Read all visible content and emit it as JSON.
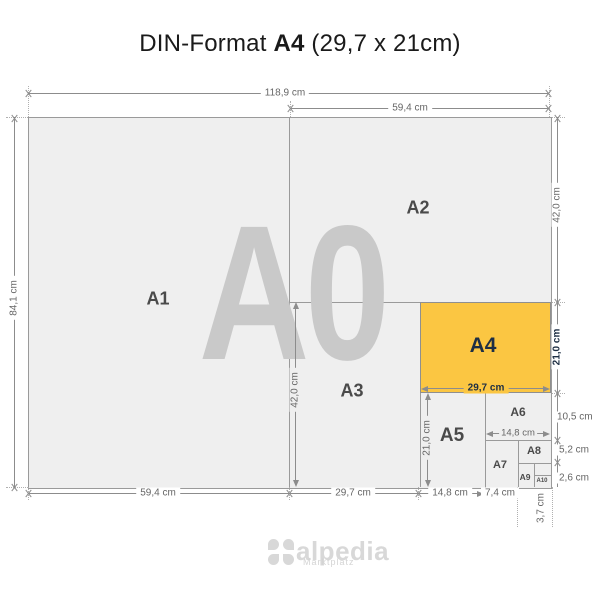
{
  "title": {
    "prefix": "DIN-Format",
    "format": "A4",
    "size": "(29,7 x 21cm)"
  },
  "watermark": "A0",
  "formats": {
    "a1": "A1",
    "a2": "A2",
    "a3": "A3",
    "a4": "A4",
    "a5": "A5",
    "a6": "A6",
    "a7": "A7",
    "a8": "A8",
    "a9": "A9",
    "a10": "A10"
  },
  "dims": {
    "top_full": "118,9 cm",
    "top_half": "59,4 cm",
    "left_height": "84,1 cm",
    "right_a2": "42,0 cm",
    "right_a4": "21,0 cm",
    "right_a6": "10,5 cm",
    "right_a8": "5,2 cm",
    "right_a10": "2,6 cm",
    "bottom_a1": "59,4 cm",
    "bottom_a3": "29,7 cm",
    "bottom_a5": "14,8 cm",
    "bottom_a7": "7,4 cm",
    "bottom_a9": "3,7 cm",
    "inner_a3_height": "42,0 cm",
    "inner_a5_height": "21,0 cm",
    "inner_a4_width": "29,7 cm",
    "inner_a6_width": "14,8 cm"
  },
  "logo": {
    "name": "alpedia",
    "tagline": "Marktplatz"
  },
  "colors": {
    "highlight": "#fbc642",
    "sheet": "#efefef",
    "watermark": "#c9c9c9",
    "accent_text": "#1e2f44"
  }
}
